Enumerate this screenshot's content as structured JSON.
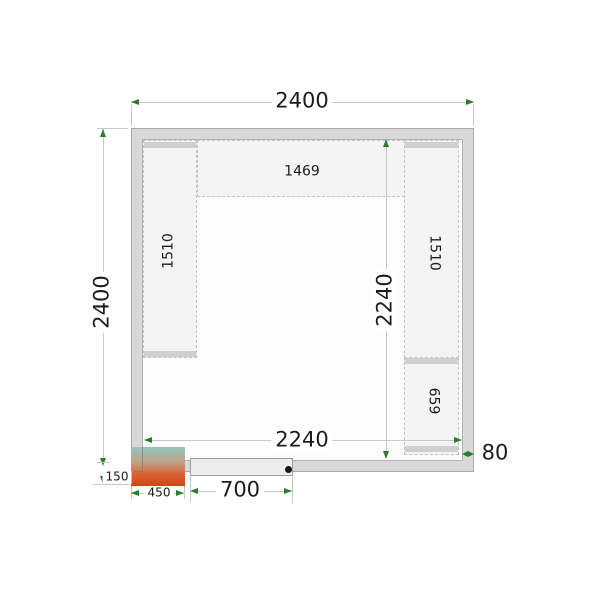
{
  "dimensions": {
    "outer_width": "2400",
    "outer_depth": "2400",
    "inner_width": "2240",
    "inner_depth": "2240",
    "wall_thickness": "80",
    "door_width": "700",
    "unit_width": "450",
    "unit_depth": "150"
  },
  "shelves": {
    "top": "1469",
    "left": "1510",
    "right_upper": "1510",
    "right_lower": "659"
  },
  "colors": {
    "wall_fill": "#d8d8d8",
    "floor_fill": "#fdfdfd",
    "shelf_fill": "#f4f4f4",
    "shelf_cap": "#cfcfcf",
    "door_fill": "#ececec",
    "dimension_line": "#c0cdc0",
    "dimension_arrow": "#2c7c2c",
    "unit_gradient_top": "#93c6be",
    "unit_gradient_bottom": "#dc4015"
  }
}
